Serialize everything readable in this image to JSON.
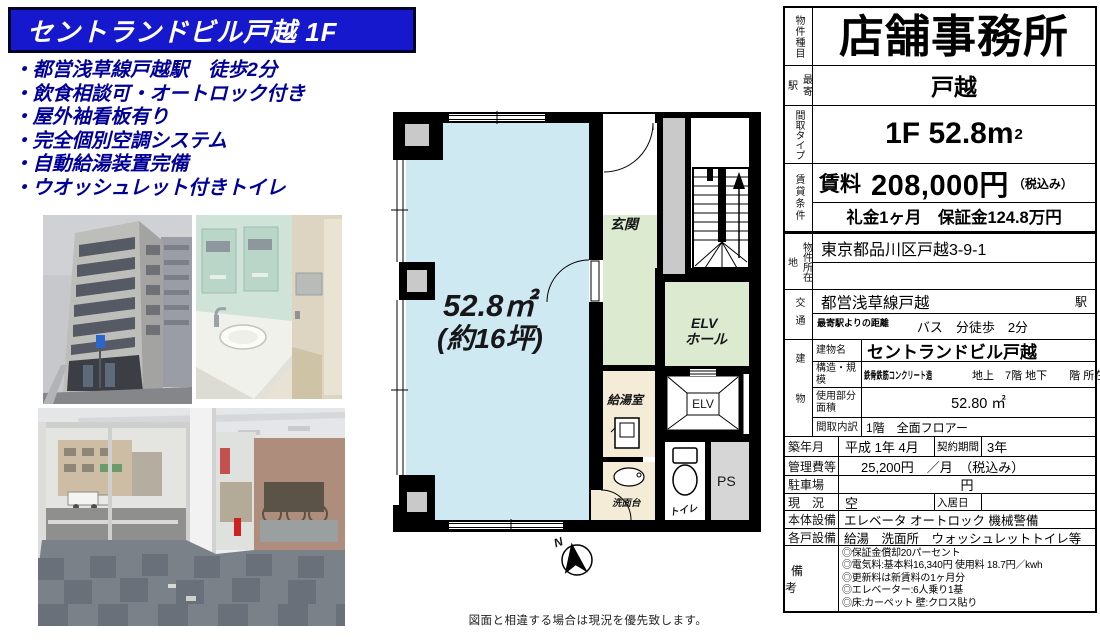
{
  "header": {
    "title": "セントランドビル戸越 1F"
  },
  "features": {
    "items": [
      "・都営浅草線戸越駅　徒歩2分",
      "・飲食相談可・オートロック付き",
      "・屋外袖看板有り",
      "・完全個別空調システム",
      "・自動給湯装置完備",
      "・ウオッシュレット付きトイレ"
    ]
  },
  "floorplan": {
    "area": "52.8㎡",
    "area_tsubo": "(約16坪)",
    "labels": {
      "genkan": "玄関",
      "elv_hall_1": "ELV",
      "elv_hall_2": "ホール",
      "kyutou": "給湯室",
      "senmendai": "洗面台",
      "toilet": "トイレ",
      "ps": "PS",
      "elv": "ELV",
      "north": "N"
    },
    "footnote": "図面と相違する場合は現況を優先致します。"
  },
  "table": {
    "property_type_label": "物件種目",
    "property_type": "店舗事務所",
    "station_label": "最寄駅",
    "station": "戸越",
    "layout_label": "間取タイプ",
    "layout_main": "1F 52.8m",
    "layout_sup": "2",
    "terms_label": "賃貸条件",
    "rent_label": "賃料",
    "rent": "208,000円",
    "rent_tax": "（税込み）",
    "deposit": "礼金1ヶ月　保証金124.8万円",
    "address_label": "物件所在地",
    "address": "東京都品川区戸越3-9-1",
    "access_label": "交通",
    "access_line": "都営浅草線戸越",
    "access_station_suffix": "駅",
    "access_distance_label": "最寄駅よりの距離",
    "access_distance": "バス　分徒歩　2分",
    "building_label": "建物",
    "building_name_label": "建物名",
    "building_name": "セントランドビル戸越",
    "structure_label": "構造・規模",
    "structure": "鉄骨鉄筋コンクリート造",
    "structure_detail": "地上　7階 地下　　階 所在階　1階",
    "used_area_label": "使用部分面積",
    "used_area": "52.80 ㎡",
    "madori_label": "間取内訳",
    "madori": "1階　全面フロアー",
    "built_label": "築年月",
    "built": "平成 1年 4月",
    "contract_label": "契約期間",
    "contract": "3年",
    "fee_label": "管理費等",
    "fee": "25,200円　／月　（税込み）",
    "parking_label": "駐車場",
    "parking": "円",
    "status_label": "現　況",
    "status": "空",
    "movein_label": "入居日",
    "main_equip_label": "本体設備",
    "main_equip": "エレベータ オートロック 機械警備",
    "unit_equip_label": "各戸設備",
    "unit_equip": "給湯　洗面所　ウォッシュレットトイレ等",
    "notes_label": "備　考",
    "notes": [
      "◎保証金償却20パーセント",
      "◎電気料:基本料16,340円 使用料 18.7円／kwh",
      "◎更新料は新賃料の1ヶ月分",
      "◎エレベーター:6人乗り1基",
      "◎床:カーペット 壁:クロス貼り"
    ]
  }
}
